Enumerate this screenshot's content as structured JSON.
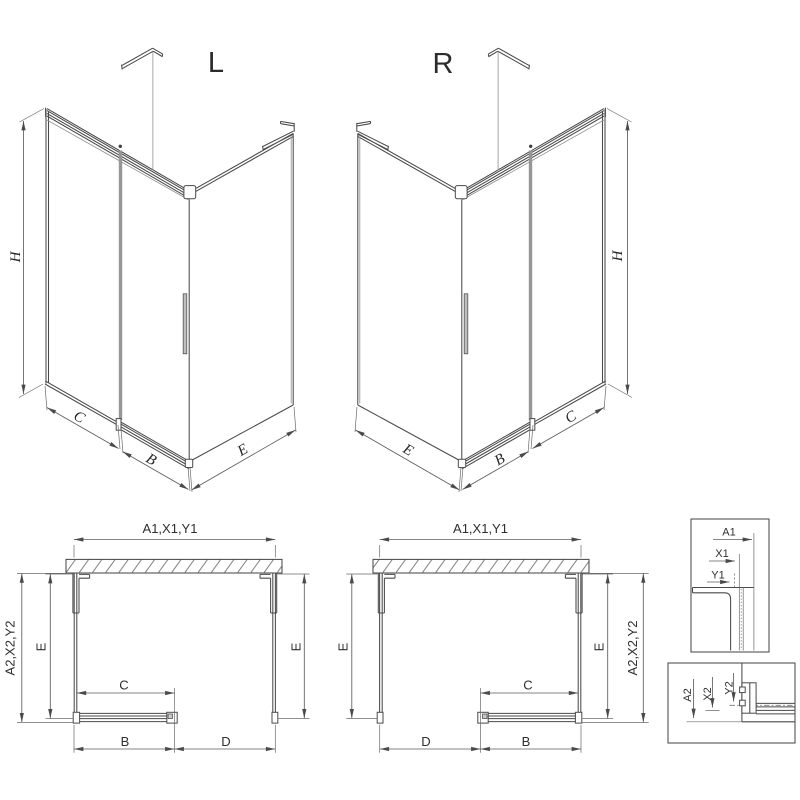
{
  "drawing": {
    "title_left": "L",
    "title_right": "R",
    "iso_left": {
      "h": "H",
      "c": "C",
      "b": "B",
      "e": "E"
    },
    "iso_right": {
      "h": "H",
      "e": "E",
      "b": "B",
      "c": "C"
    },
    "plan_left": {
      "top": "A1,X1,Y1",
      "outer": "A2,X2,Y2",
      "e_left": "E",
      "e_right": "E",
      "c": "C",
      "b": "B",
      "d": "D"
    },
    "plan_right": {
      "top": "A1,X1,Y1",
      "outer": "A2,X2,Y2",
      "e_left": "E",
      "e_right": "E",
      "c": "C",
      "b": "B",
      "d": "D"
    },
    "detail_top": {
      "a1": "A1",
      "x1": "X1",
      "y1": "Y1"
    },
    "detail_bottom": {
      "a2": "A2",
      "x2": "X2",
      "y2": "Y2"
    },
    "colors": {
      "line": "#4a4a4a",
      "dim": "#5c5c5c",
      "light_gray": "#979797",
      "text": "#2e2e2e",
      "background": "#ffffff"
    }
  }
}
